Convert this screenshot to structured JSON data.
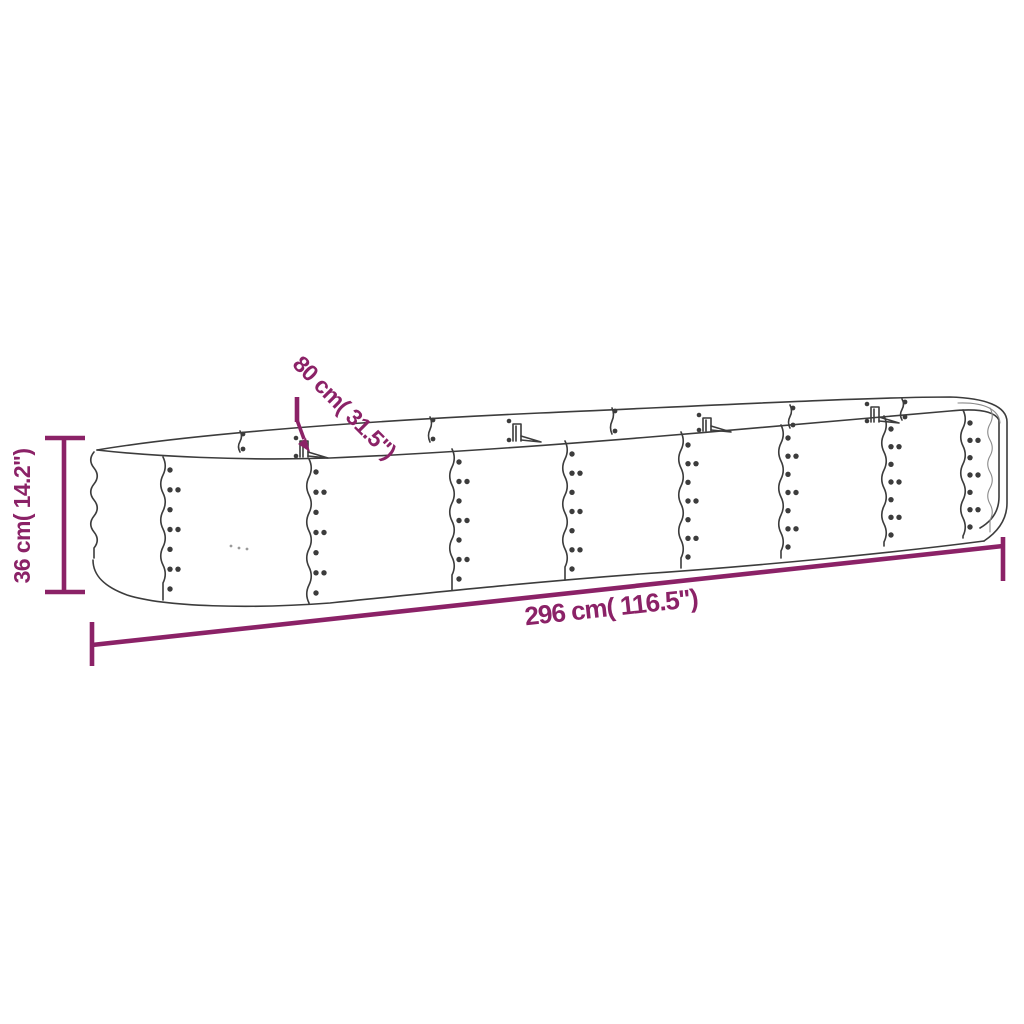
{
  "labels": {
    "height": "36 cm( 14.2\")",
    "depth": "80 cm( 31.5\")",
    "length": "296 cm( 116.5\")"
  },
  "colors": {
    "dimension_accent": "#8B2267",
    "line_art": "#3C3C3C",
    "background": "#FFFFFF"
  }
}
